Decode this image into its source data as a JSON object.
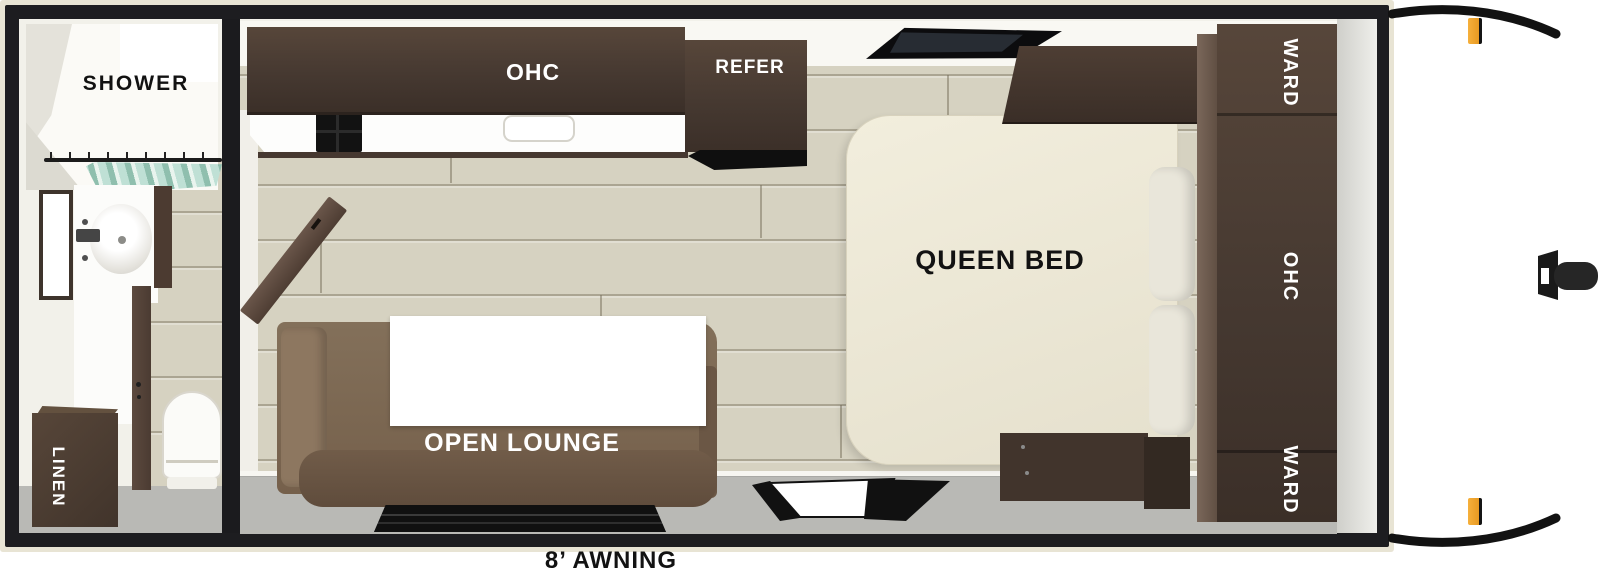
{
  "floorplan": {
    "bathroom": {
      "shower_label": "SHOWER",
      "linen_label": "LINEN"
    },
    "kitchen": {
      "overhead_cabinet_label": "OHC",
      "refrigerator_label": "REFER"
    },
    "bedroom": {
      "bed_label": "QUEEN BED",
      "wardrobe_top_label": "WARD",
      "overhead_cabinet_label": "OHC",
      "wardrobe_bottom_label": "WARD"
    },
    "lounge": {
      "lounge_label": "OPEN LOUNGE"
    },
    "exterior": {
      "awning_label": "8’ AWNING"
    },
    "colors": {
      "wall_black": "#1d1d20",
      "trim_beige": "#e8e4d4",
      "cabinet_dark_brown": "#4a3a31",
      "sofa_brown": "#7d6751",
      "bed_cream": "#efeadb",
      "floor_wood": "#d6d2c1",
      "floor_gray": "#b9b9b5",
      "curtain_teal": "#a5cec0",
      "marker_light_orange": "#f2a93b"
    }
  }
}
